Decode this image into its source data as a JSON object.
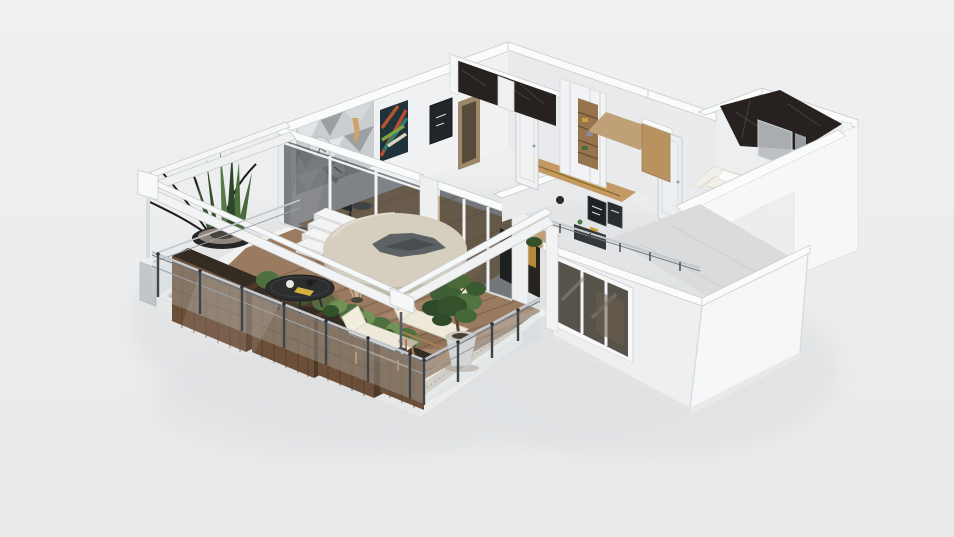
{
  "view": {
    "kind": "3d-floorplan-isometric-render",
    "content": "apartment with large wooden terrace",
    "background_top": "#eef0f1",
    "background_bottom": "#e9eaeb"
  },
  "colors": {
    "bg": "#ecedee",
    "shadow": "#dfe1e3",
    "ridge": "#fafbfb",
    "edge": "#c6c9cc",
    "wall_face": "#eff1f2",
    "wall_shaded": "#e8eaec",
    "wall_lit": "#f6f7f8",
    "slab": "#f2f2f1",
    "slab_side": "#e6e7e7",
    "gravel": "#d3ccc0",
    "gravel_dot": "#b1a794",
    "deck": "#9b7b60",
    "deck_plank": "#77593f",
    "deck_light": "#b89d86",
    "planter_wood": "#6b4f38",
    "planter_side": "#4e3826",
    "planter_line": "#503a29",
    "soil": "#342b22",
    "plant_green": "#4e6f3e",
    "plant_light": "#6f9355",
    "plant_dark": "#33512a",
    "twig": "#1b1b1b",
    "dried_grass": "#c9b89a",
    "bowl": "#262626",
    "bowl_gravel": "#8d8679",
    "glass_interior": "#181d22",
    "glass_rail": "#cdd6db",
    "window_glass": "#57534b",
    "marble": "#27221f",
    "marble_vein": "#564e45",
    "wood_floor": "#c0a077",
    "wood_closet": "#b8925f",
    "kitchen_wood": "#c39a66",
    "gold": "#c9a23a",
    "table_top": "#d6cfc0",
    "table_side": "#c2baa9",
    "table_obj": "#5d6265",
    "coffee_table": "#2c2d2f",
    "lounger_cushion": "#efe9dc",
    "lounger_frame": "#a97f4f",
    "pot": "#d6d6d2",
    "trunk": "#5a4632",
    "rail_metal": "#c2c8cd",
    "rail_dark": "#747c83",
    "post": "#3f4449",
    "door": "#f1f2f3",
    "door_edge": "#c9cccf",
    "bed": "#f1efe9",
    "pillow": "#fbfbf9",
    "art_teal": "#2e7d6e",
    "art_red": "#bf4a33",
    "art_green": "#7aa642",
    "art_navy": "#20333a",
    "art_cream": "#e0d6c2",
    "mosaic": "#c9cdd0",
    "mosaic_dark": "#9aa0a4",
    "mosaic_light": "#e2e5e7",
    "plate": "#dcdedf",
    "shower_glass": "#b9bdc0",
    "floor_gray": "#d9dbdc",
    "frame_dark": "#1f2225",
    "chair_dark": "#2a2a2e"
  },
  "scene": {
    "objects": [
      "terrace-deck",
      "gravel-border",
      "wood-planter-boxes",
      "snake-plant-bowl",
      "hedge-shrubs",
      "dried-grass-pot",
      "black-coffee-table",
      "round-daybed-table",
      "leaf-centerpiece",
      "sun-lounger",
      "sun-lounger",
      "potted-tree",
      "white-steps",
      "pergola-beams",
      "pergola-post",
      "glass-railing",
      "railing-posts",
      "living-room",
      "geometric-mosaic-wall",
      "chevron-painting",
      "dark-art-frame",
      "interior-dining-chair",
      "sliding-glass-doors",
      "hallway-door",
      "kitchen-counter",
      "dark-marble-bathroom",
      "wardrobe-closet",
      "shelf-unit",
      "second-marble-bathroom",
      "shower-glass-panel",
      "bedroom",
      "bedroom-door",
      "wall-art-frames",
      "sideboard",
      "bed-with-pillows",
      "white-volume",
      "three-pane-window",
      "balcony-rail"
    ]
  }
}
